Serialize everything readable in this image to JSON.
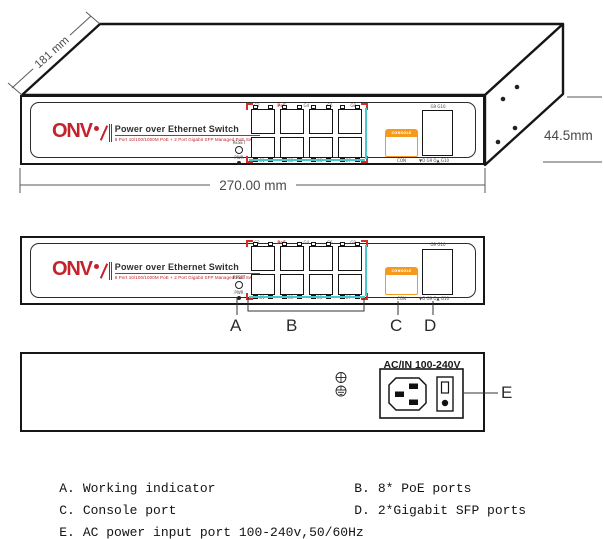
{
  "panel": {
    "brand": "ONV",
    "title": "Power over Ethernet Switch",
    "subtitle": "8 Port 10/100/1000M PoE + 2 Port Gigabit SFP Managed PoE Switch",
    "reset_label": "RESET",
    "pwr_label": "PWR",
    "poe_mark": "PoE",
    "ports_top": [
      "G2",
      "G4",
      "G6",
      "G8"
    ],
    "ports_bottom": [
      "G1",
      "G3",
      "G5",
      "G7"
    ],
    "console_label": "CONSOLE",
    "console_sub": "CON",
    "sfp_label": "G9 G10",
    "sfp_sub": "▼O G9  O▲ G10"
  },
  "dimensions": {
    "depth": "181 mm",
    "width": "270.00 mm",
    "height": "44.5mm"
  },
  "rear": {
    "ac_label": "AC/IN 100-240V"
  },
  "callouts": {
    "a": "A",
    "b": "B",
    "c": "C",
    "d": "D",
    "e": "E"
  },
  "legend": {
    "a_key": "A.",
    "a_text": "Working indicator",
    "b_key": "B.",
    "b_text": "8* PoE ports",
    "c_key": "C.",
    "c_text": "Console port",
    "d_key": "D.",
    "d_text": "2*Gigabit SFP ports",
    "e_key": "E.",
    "e_text": "AC power input port 100-240v,50/60Hz"
  },
  "colors": {
    "brand_red": "#c4232b",
    "corner_red": "#d03028",
    "console_orange": "#f59a1d",
    "port_cyan": "#49c8cb"
  }
}
